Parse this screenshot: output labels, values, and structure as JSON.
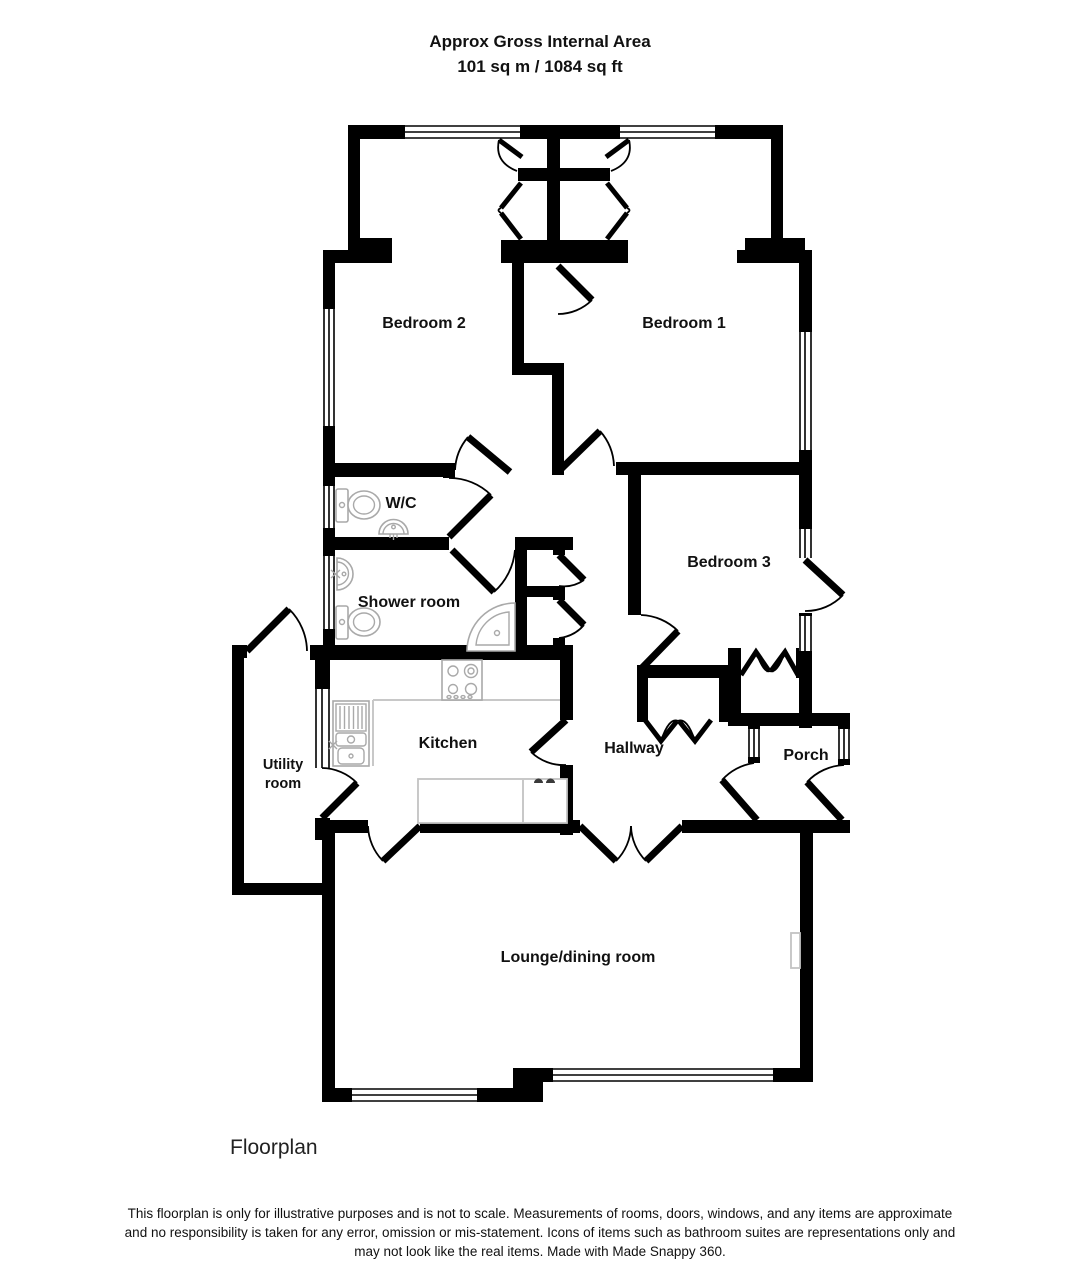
{
  "header": {
    "line1": "Approx Gross Internal Area",
    "line2": "101 sq m / 1084 sq ft"
  },
  "rooms": {
    "bedroom2": "Bedroom 2",
    "bedroom1": "Bedroom 1",
    "wc": "W/C",
    "shower": "Shower room",
    "bedroom3": "Bedroom 3",
    "utility_line1": "Utility",
    "utility_line2": "room",
    "kitchen": "Kitchen",
    "hallway": "Hallway",
    "porch": "Porch",
    "lounge": "Lounge/dining room"
  },
  "icons": [
    "toilet-icon",
    "basin-icon",
    "shower-tray-icon",
    "hob-icon",
    "kitchen-sink-icon",
    "radiator-icon"
  ],
  "colors": {
    "wall": "#000000",
    "fixture": "#a9a9a9",
    "background": "#ffffff",
    "text": "#111111"
  },
  "footer": {
    "caption": "Floorplan",
    "disclaimer": "This floorplan is only for illustrative purposes and is not to scale. Measurements of rooms, doors, windows, and any items are approximate and no responsibility is taken for any error, omission or mis-statement. Icons of items such as bathroom suites are representations only and may not look like the real items. Made with Made Snappy 360."
  }
}
